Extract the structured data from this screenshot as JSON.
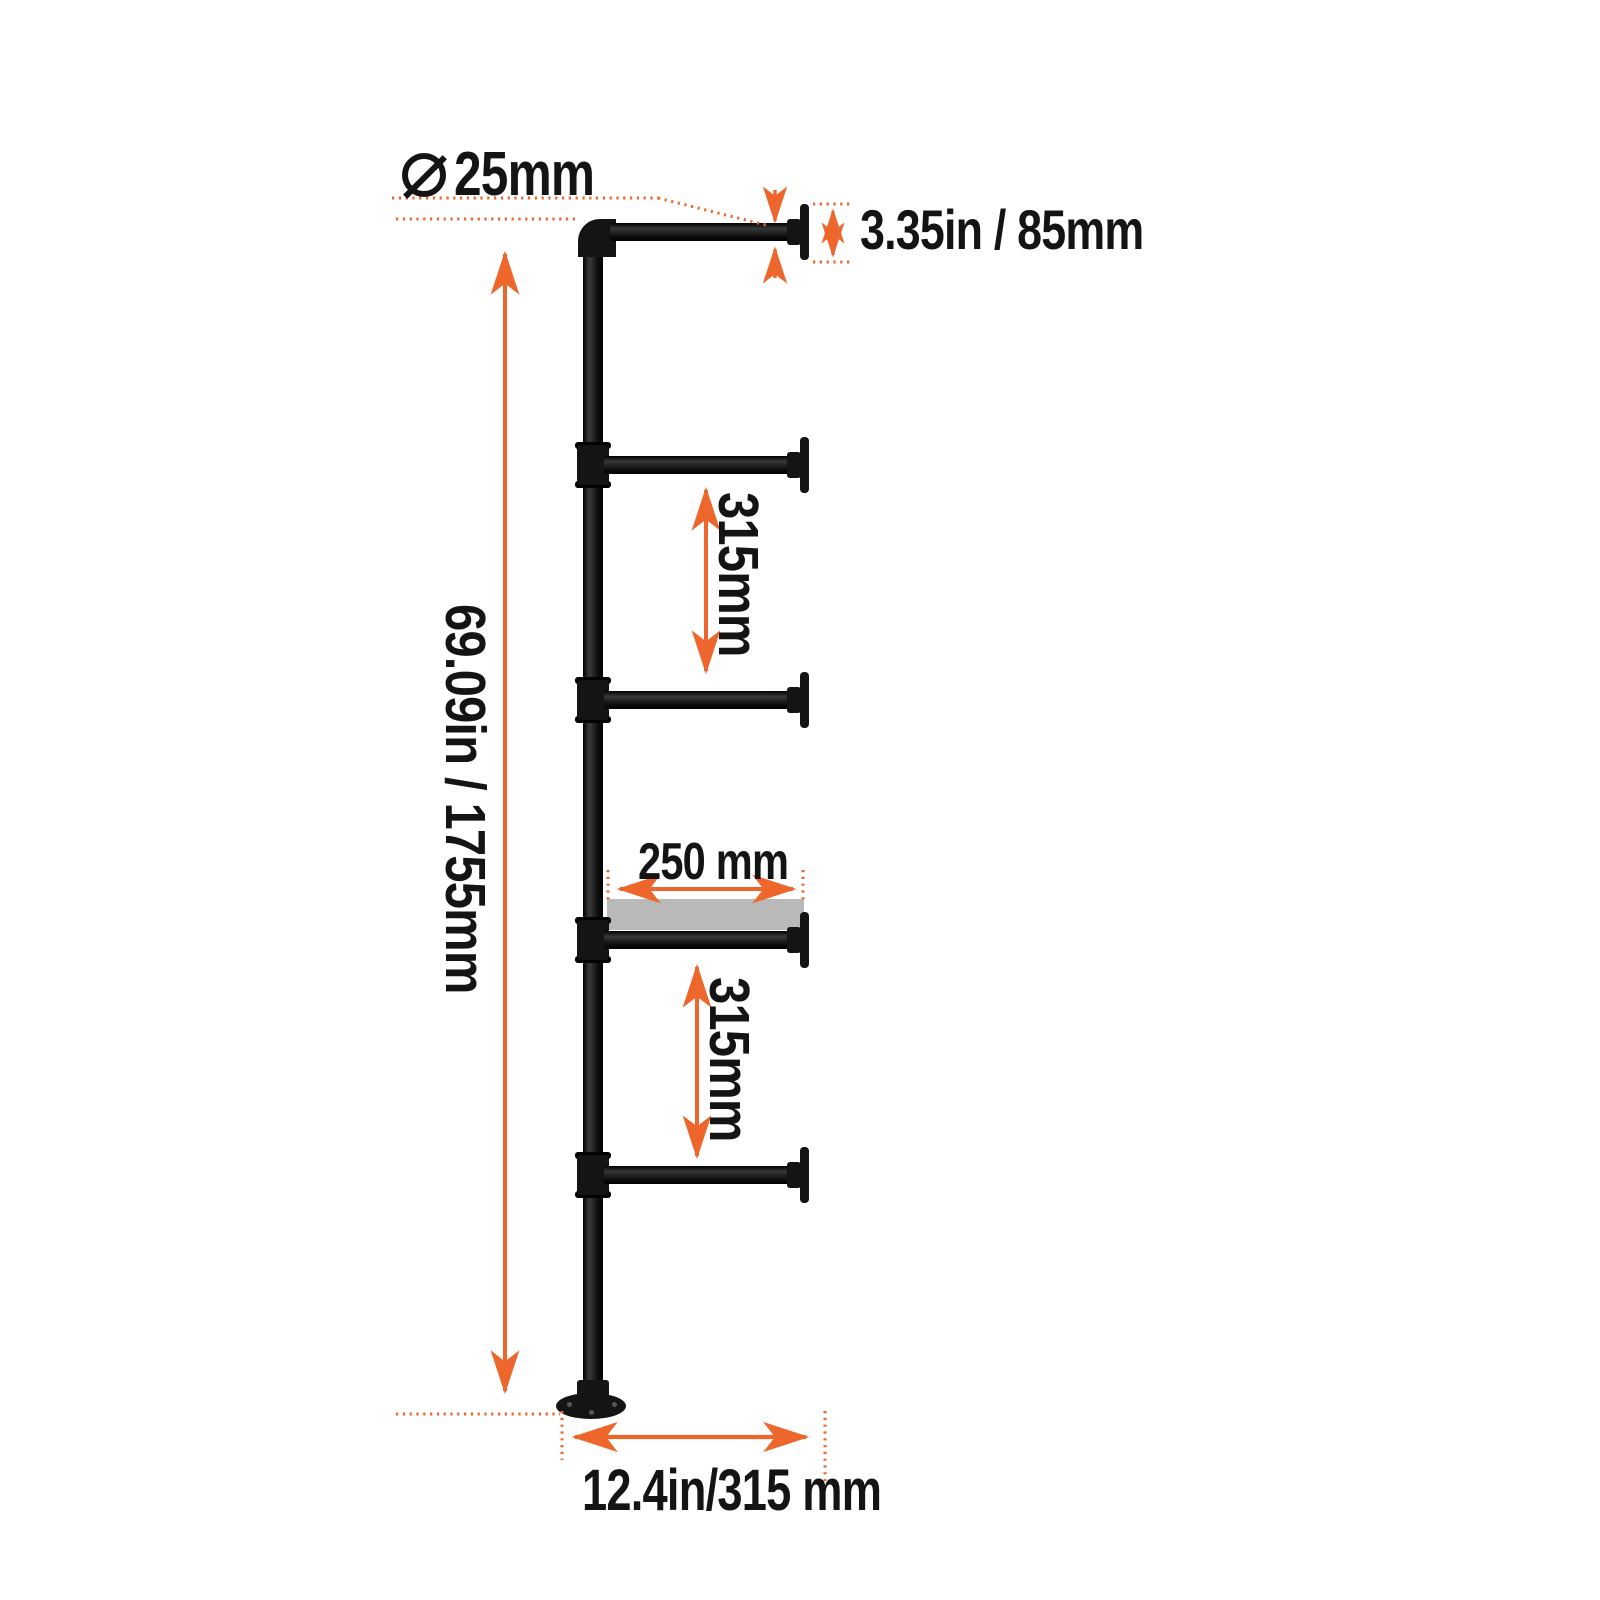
{
  "diagram": {
    "kind": "industrial pipe shelf bracket dimension drawing",
    "background": "#ffffff",
    "accent_color": "#ED662C",
    "pipe_color": "#141414",
    "shelf_color": "#b9b9b9",
    "labels": {
      "pipe_diameter": "25mm",
      "wall_flange_size": "3.35in / 85mm",
      "upper_shelf_spacing": "315mm",
      "shelf_depth": "250 mm",
      "lower_shelf_spacing": "315mm",
      "total_height": "69.09in / 1755mm",
      "base_depth": "12.4in/315 mm"
    },
    "measurements": [
      {
        "name": "pipe diameter",
        "value": "25mm",
        "orientation": "horizontal"
      },
      {
        "name": "wall flange height",
        "value": "3.35in / 85mm",
        "orientation": "horizontal"
      },
      {
        "name": "spacing between upper arms",
        "value": "315mm",
        "orientation": "vertical"
      },
      {
        "name": "shelf board depth",
        "value": "250 mm",
        "orientation": "horizontal"
      },
      {
        "name": "spacing between lower arms",
        "value": "315mm",
        "orientation": "vertical"
      },
      {
        "name": "overall height",
        "value": "69.09in / 1755mm",
        "orientation": "vertical"
      },
      {
        "name": "arm / base depth",
        "value": "12.4in/315 mm",
        "orientation": "horizontal"
      }
    ]
  }
}
